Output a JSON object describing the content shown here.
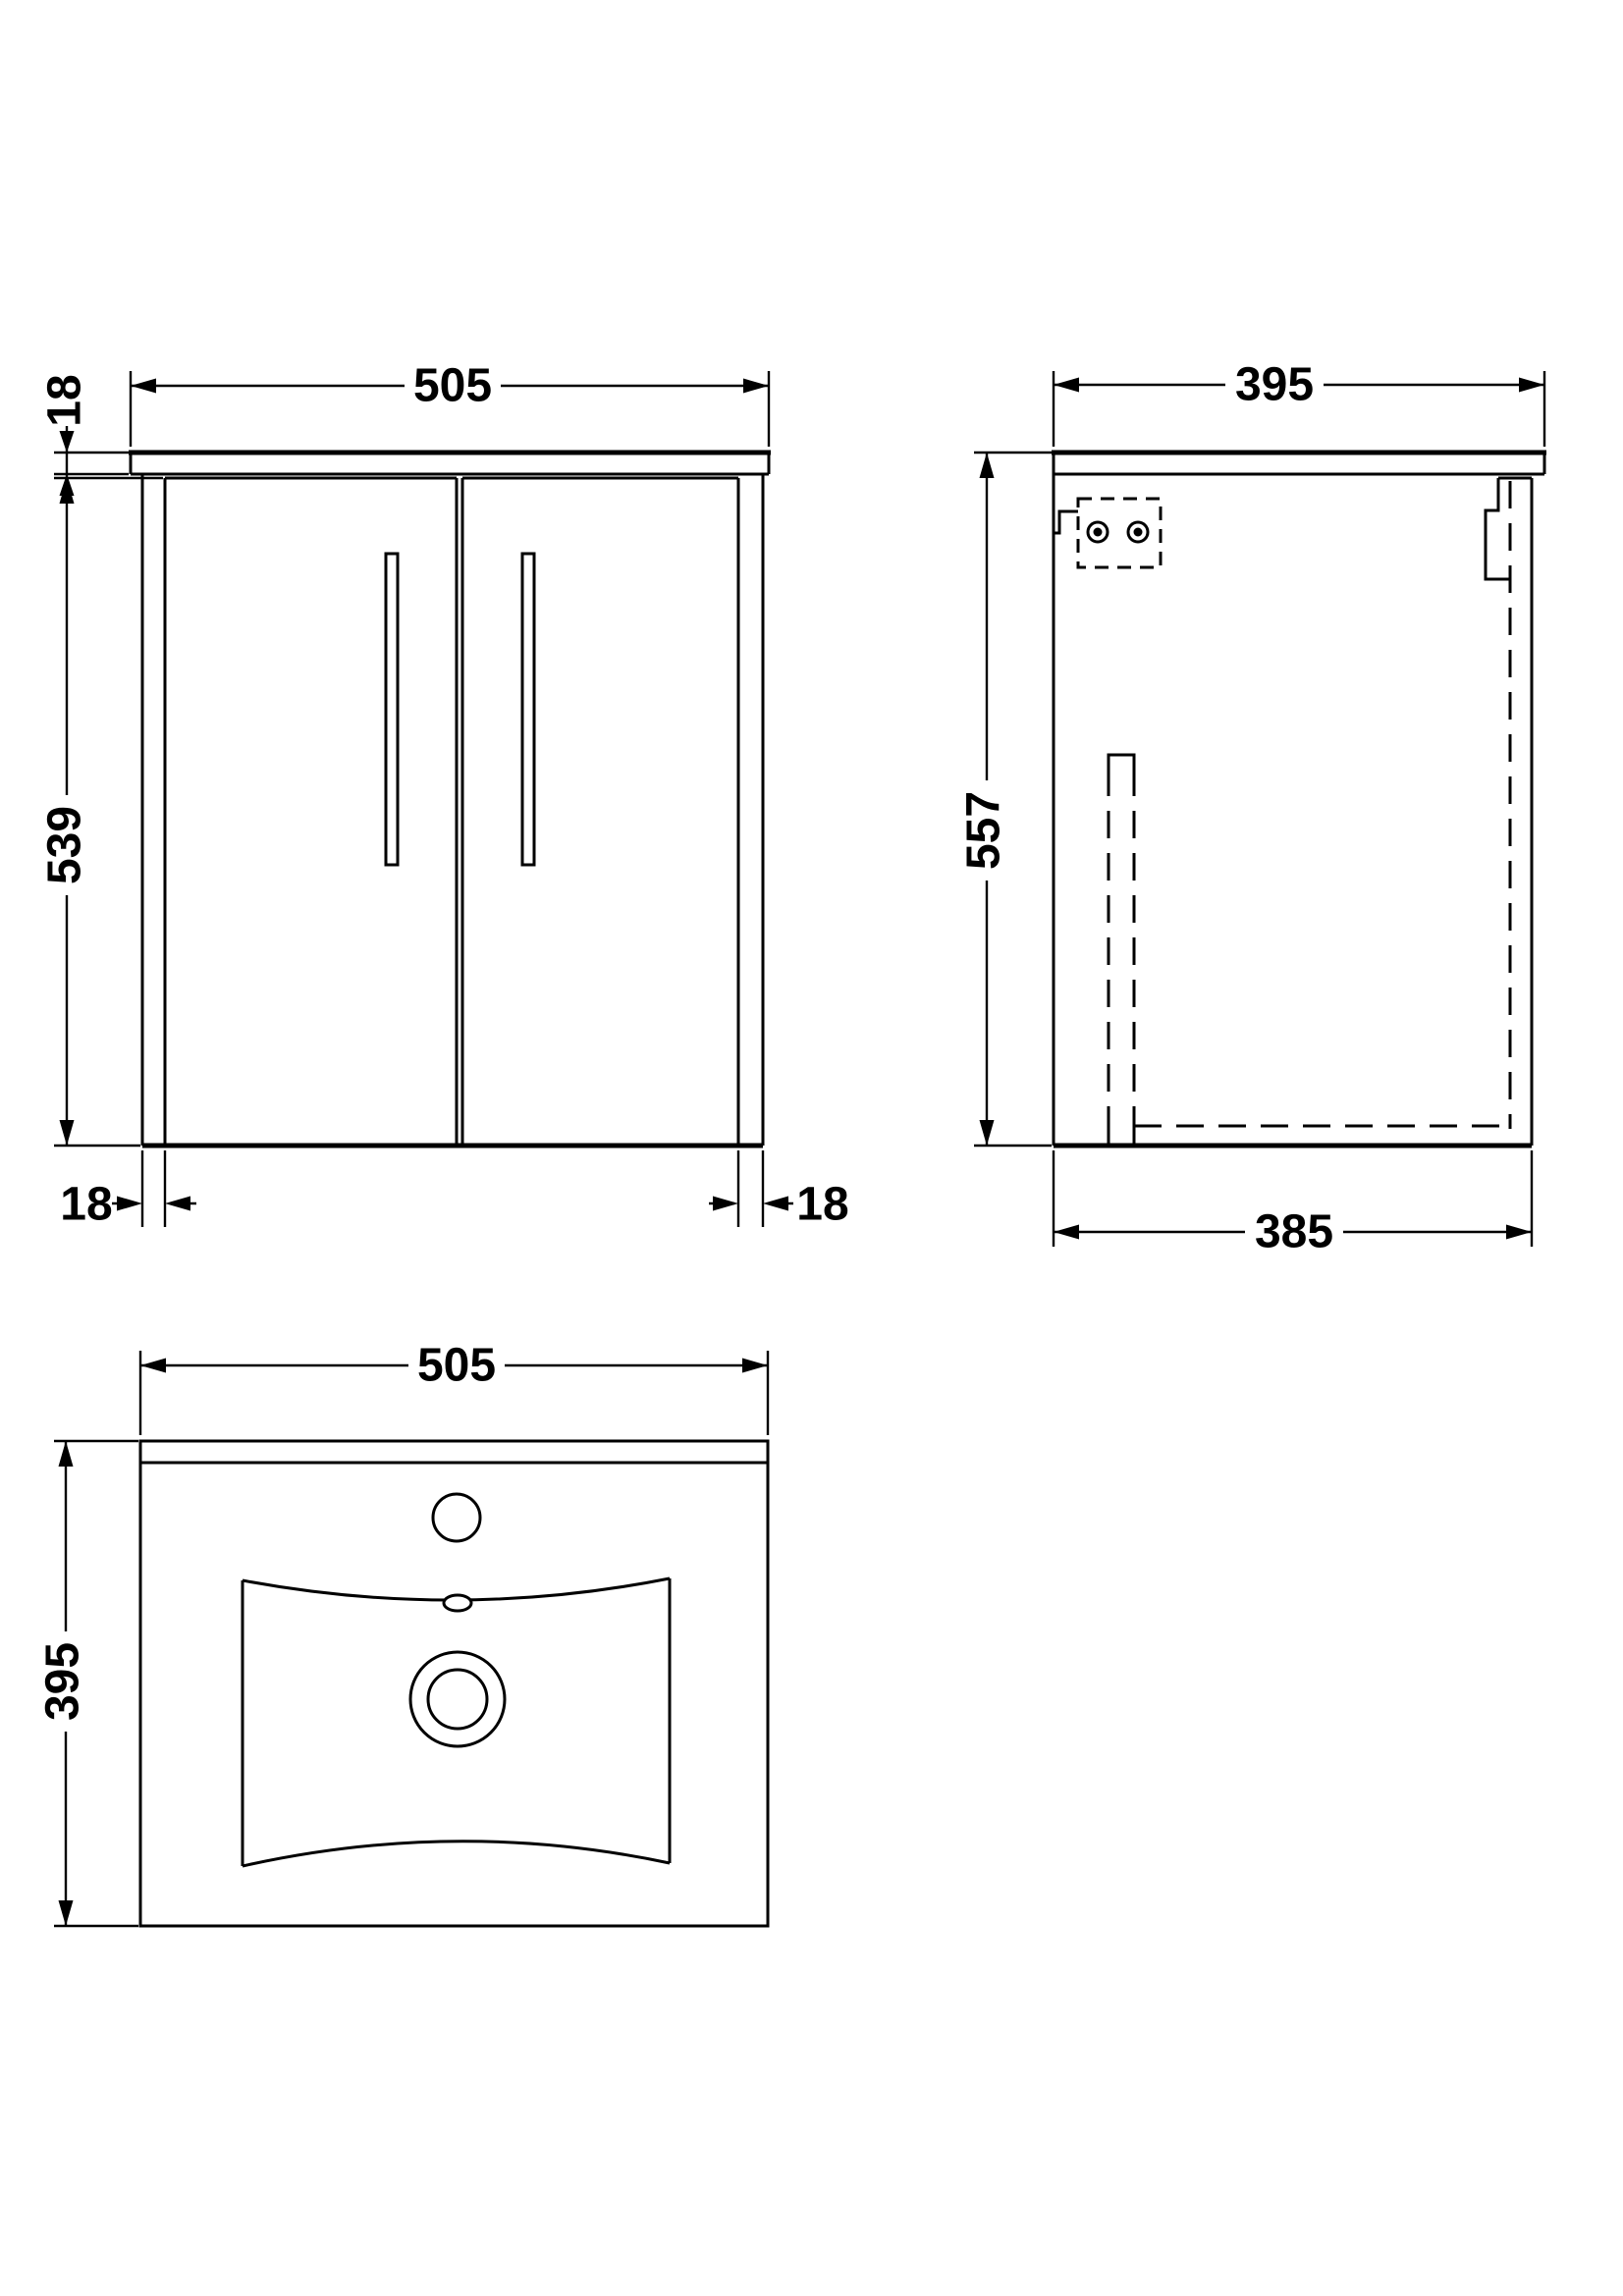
{
  "drawing": {
    "front": {
      "width": "505",
      "worktop_thickness": "18",
      "door_height": "539",
      "left_panel_thickness": "18",
      "right_panel_thickness": "18"
    },
    "side": {
      "worktop_depth": "395",
      "overall_height": "557",
      "carcass_depth": "385"
    },
    "plan": {
      "width": "505",
      "depth": "395"
    }
  }
}
